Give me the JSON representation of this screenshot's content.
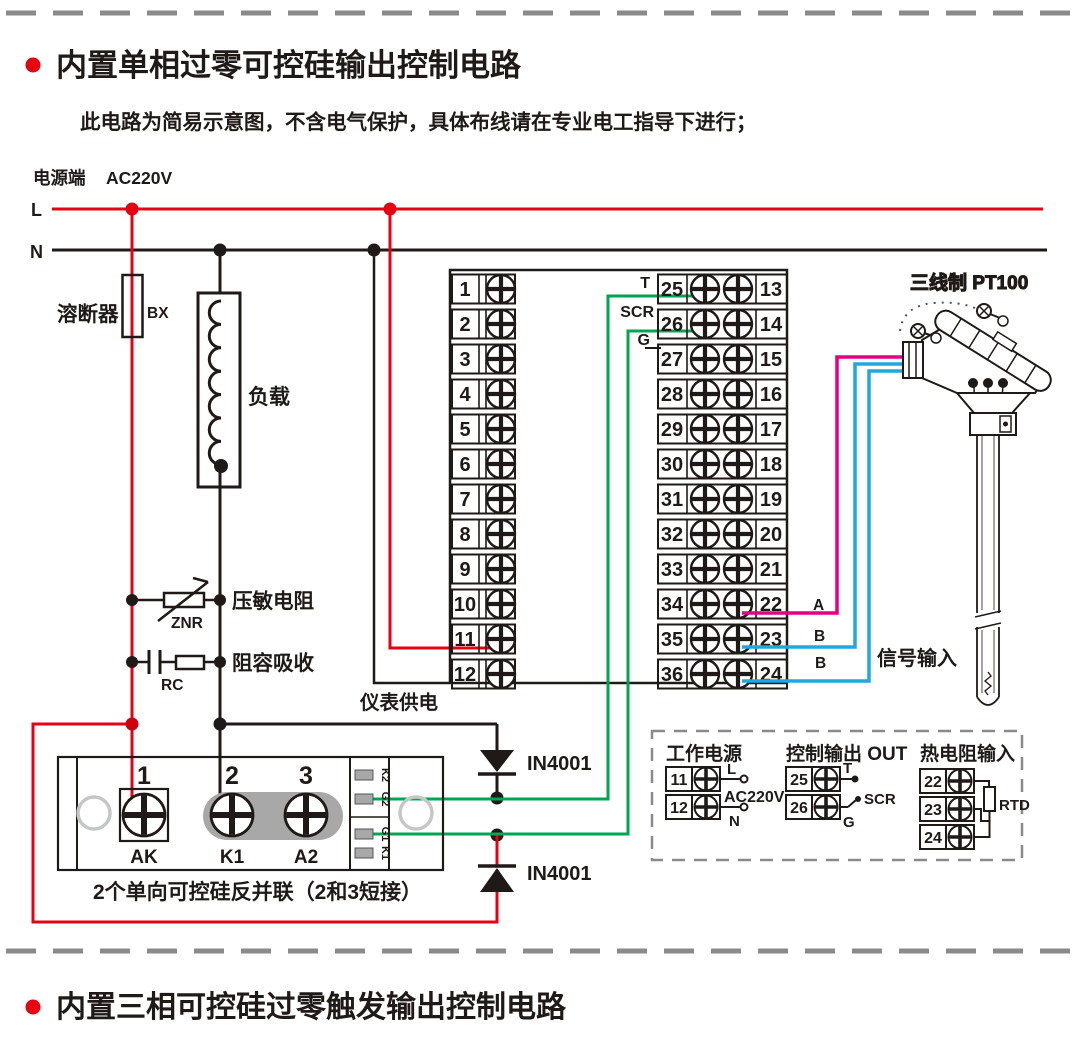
{
  "page": {
    "section1_title": "内置单相过零可控硅输出控制电路",
    "section1_note": "此电路为简易示意图，不含电气保护，具体布线请在专业电工指导下进行；",
    "section2_title": "内置三相可控硅过零触发输出控制电路"
  },
  "power": {
    "source_label": "电源端",
    "voltage": "AC220V",
    "l": "L",
    "n": "N"
  },
  "components": {
    "fuse": "溶断器",
    "fuse_code": "BX",
    "load": "负载",
    "varistor": "压敏电阻",
    "varistor_code": "ZNR",
    "rc": "阻容吸收",
    "rc_code": "RC",
    "meter_supply": "仪表供电",
    "diode_top": "IN4001",
    "diode_bottom": "IN4001",
    "scr_caption": "2个单向可控硅反并联（2和3短接）"
  },
  "outputs": {
    "t": "T",
    "scr": "SCR",
    "g": "G"
  },
  "scr_module": {
    "n1": "1",
    "n2": "2",
    "n3": "3",
    "l1": "AK",
    "l2": "K1",
    "l3": "A2",
    "pins": [
      "K2",
      "G2",
      "G1",
      "K1"
    ]
  },
  "sensor": {
    "title": "三线制 PT100",
    "wire_a": "A",
    "wire_b1": "B",
    "wire_b2": "B",
    "signal": "信号输入"
  },
  "terminals": {
    "left": [
      "1",
      "2",
      "3",
      "4",
      "5",
      "6",
      "7",
      "8",
      "9",
      "10",
      "11",
      "12"
    ],
    "mid": [
      "25",
      "26",
      "27",
      "28",
      "29",
      "30",
      "31",
      "32",
      "33",
      "34",
      "35",
      "36"
    ],
    "right": [
      "13",
      "14",
      "15",
      "16",
      "17",
      "18",
      "19",
      "20",
      "21",
      "22",
      "23",
      "24"
    ]
  },
  "legend": {
    "power": {
      "title": "工作电源",
      "t1": "11",
      "t2": "12",
      "l": "L",
      "n": "N",
      "voltage": "AC220V"
    },
    "output": {
      "title": "控制输出 OUT",
      "t1": "25",
      "t2": "26",
      "t": "T",
      "scr": "SCR",
      "g": "G"
    },
    "rtd": {
      "title": "热电阻输入",
      "t1": "22",
      "t2": "23",
      "t3": "24",
      "label": "RTD"
    }
  },
  "colors": {
    "line_l": "#e60012",
    "line_n": "#1f1a17",
    "gate_wire": "#00a551",
    "rtd_a": "#e4007f",
    "rtd_b": "#1fa8e0",
    "dashed_border": "#8a8a8a",
    "short_bar": "#a8a8a9",
    "bullet": "#e60012"
  }
}
